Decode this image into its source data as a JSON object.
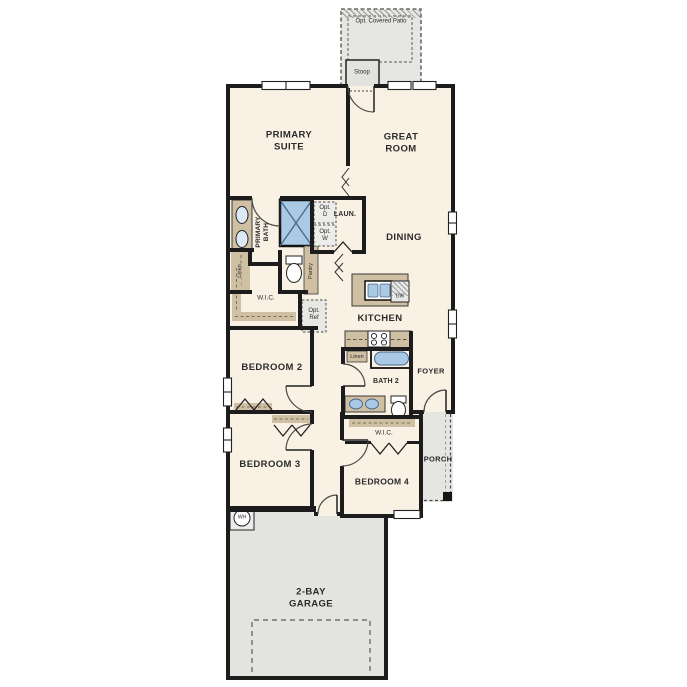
{
  "title": "Single-story floor plan",
  "palette": {
    "floor": "#f9f1e4",
    "wall": "#1c1c1c",
    "gray_zone": "#e5e5e1",
    "counter_tan": "#cfc0a4",
    "fixture_blue": "#aac9e4",
    "label_text": "#2b2b2b"
  },
  "labels": {
    "opt_covered_patio": "Opt. Covered Patio",
    "stoop": "Stoop",
    "primary_suite": "PRIMARY\nSUITE",
    "great_room": "GREAT\nROOM",
    "primary_bath": "PRIMARY\nBATH",
    "opt_dryer": "Opt.\nD",
    "opt_washer": "Opt.\nW",
    "laundry": "LAUN.",
    "linen_hall": "Linen",
    "dining": "DINING",
    "wic_primary": "W.I.C.",
    "pantry": "Pantry",
    "opt_ref": "Opt.\nRef",
    "kitchen": "KITCHEN",
    "dishwasher": "DW",
    "bedroom2": "BEDROOM 2",
    "linen_bath2": "Linen",
    "bath2": "BATH 2",
    "foyer": "FOYER",
    "bedroom3": "BEDROOM 3",
    "wic_bedroom4": "W.I.C.",
    "bedroom4": "BEDROOM 4",
    "porch": "PORCH",
    "water_heater": "WH",
    "garage": "2-BAY\nGARAGE"
  }
}
